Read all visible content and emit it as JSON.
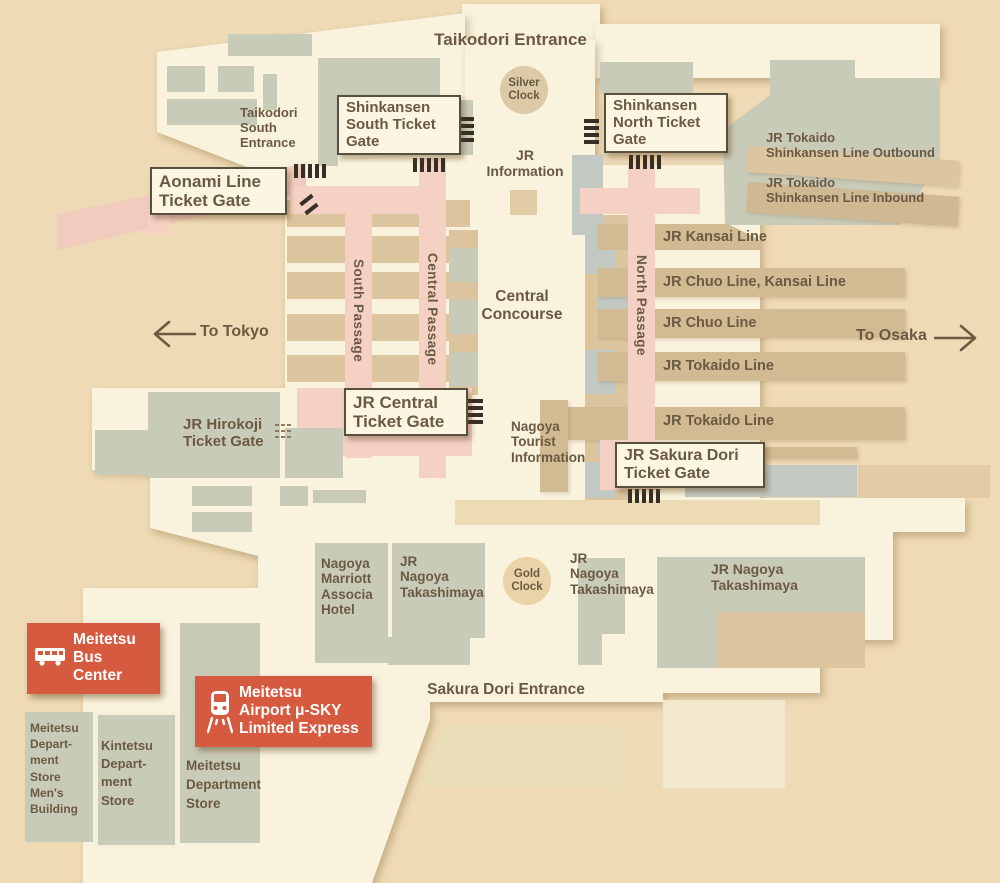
{
  "palette": {
    "background": "#eedab5",
    "floor": "#f9f2dc",
    "building_gray": "#c9cbb9",
    "platform_tan": "#d2bb93",
    "passage_pink": "#f4d1c3",
    "accent_red": "#d55a3f",
    "text_brown": "#6b5a42"
  },
  "entrances": {
    "taikodori": "Taikodori Entrance",
    "taikodori_south": [
      "Taikodori",
      "South",
      "Entrance"
    ],
    "sakura_dori": "Sakura Dori Entrance"
  },
  "gates": {
    "shinkansen_south": [
      "Shinkansen",
      "South Ticket",
      "Gate"
    ],
    "shinkansen_north": [
      "Shinkansen",
      "North Ticket",
      "Gate"
    ],
    "aonami": [
      "Aonami Line",
      "Ticket Gate"
    ],
    "jr_central": [
      "JR Central",
      "Ticket Gate"
    ],
    "jr_sakura_dori": [
      "JR Sakura Dori",
      "Ticket Gate"
    ],
    "jr_hirokoji": [
      "JR Hirokoji",
      "Ticket Gate"
    ]
  },
  "passages": {
    "south": "South Passage",
    "central": "Central Passage",
    "north": "North Passage"
  },
  "areas": {
    "central_concourse": [
      "Central",
      "Concourse"
    ],
    "jr_information": [
      "JR",
      "Information"
    ],
    "tourist_information": [
      "Nagoya",
      "Tourist",
      "Information"
    ]
  },
  "clocks": {
    "silver": [
      "Silver",
      "Clock"
    ],
    "gold": [
      "Gold",
      "Clock"
    ]
  },
  "directions": {
    "to_tokyo": "To Tokyo",
    "to_osaka": "To Osaka"
  },
  "rail_lines": {
    "shinkansen_outbound": [
      "JR Tokaido",
      "Shinkansen Line Outbound"
    ],
    "shinkansen_inbound": [
      "JR Tokaido",
      "Shinkansen Line Inbound"
    ],
    "platforms": [
      "JR Kansai Line",
      "JR Chuo Line, Kansai Line",
      "JR Chuo Line",
      "JR Tokaido Line",
      "JR Tokaido Line"
    ]
  },
  "transit": {
    "bus_center": [
      "Meitetsu",
      "Bus",
      "Center"
    ],
    "airport_express": [
      "Meitetsu",
      "Airport μ-SKY",
      "Limited Express"
    ]
  },
  "buildings": {
    "marriott": [
      "Nagoya",
      "Marriott",
      "Associa",
      "Hotel"
    ],
    "takashimaya_west": [
      "JR",
      "Nagoya",
      "Takashimaya"
    ],
    "takashimaya_center": [
      "JR",
      "Nagoya",
      "Takashimaya"
    ],
    "takashimaya_east": [
      "JR Nagoya",
      "Takashimaya"
    ],
    "meitetsu_mens": [
      "Meitetsu",
      "Depart-",
      "ment",
      "Store",
      "Men's",
      "Building"
    ],
    "kintetsu": [
      "Kintetsu",
      "Depart-",
      "ment",
      "Store"
    ],
    "meitetsu_dept": [
      "Meitetsu",
      "Department",
      "Store"
    ]
  }
}
